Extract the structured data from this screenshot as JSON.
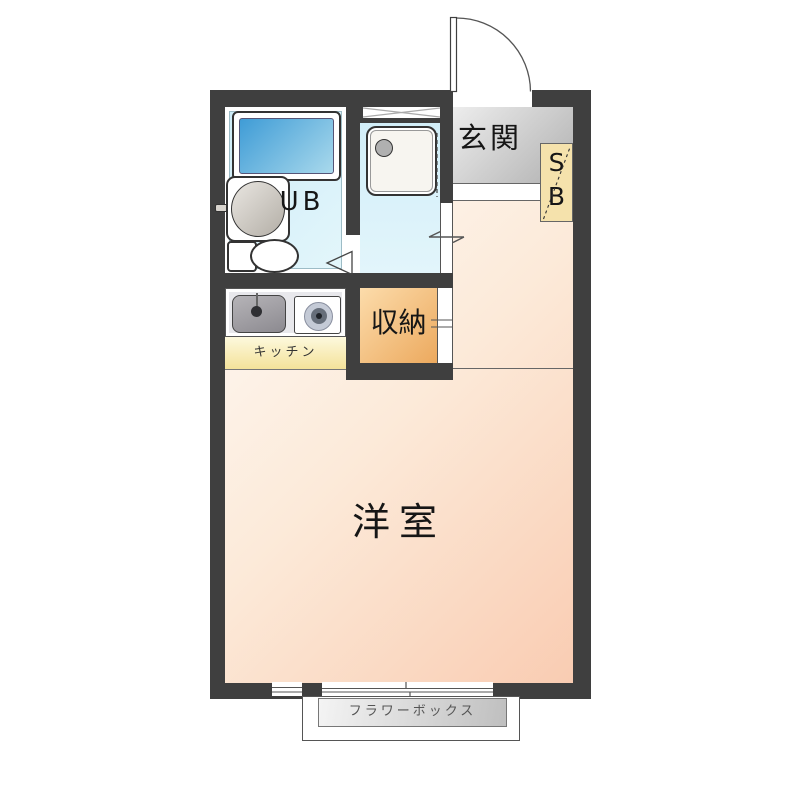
{
  "plan": {
    "entrance": {
      "label": "玄関"
    },
    "shoe_box": {
      "letters": [
        "S",
        "B"
      ]
    },
    "unit_bath": {
      "label": "UB"
    },
    "kitchen": {
      "label": "キッチン"
    },
    "storage": {
      "label": "収納"
    },
    "western_room": {
      "label": "洋室"
    },
    "flower_box": {
      "label": "フラワーボックス"
    },
    "colors": {
      "wall": "#3f3f3f",
      "wet_area_blue": "#d8f0f8",
      "bathtub_blue": "#3f9cd6",
      "entrance_gray": "#c9c9c9",
      "shoe_box_tan": "#f5e2ac",
      "storage_orange": "#f3c27f",
      "kitchen_cream": "#f9efc2",
      "room_peach": "#f9ccb2",
      "flower_box_gray": "#d9d9d9"
    }
  }
}
